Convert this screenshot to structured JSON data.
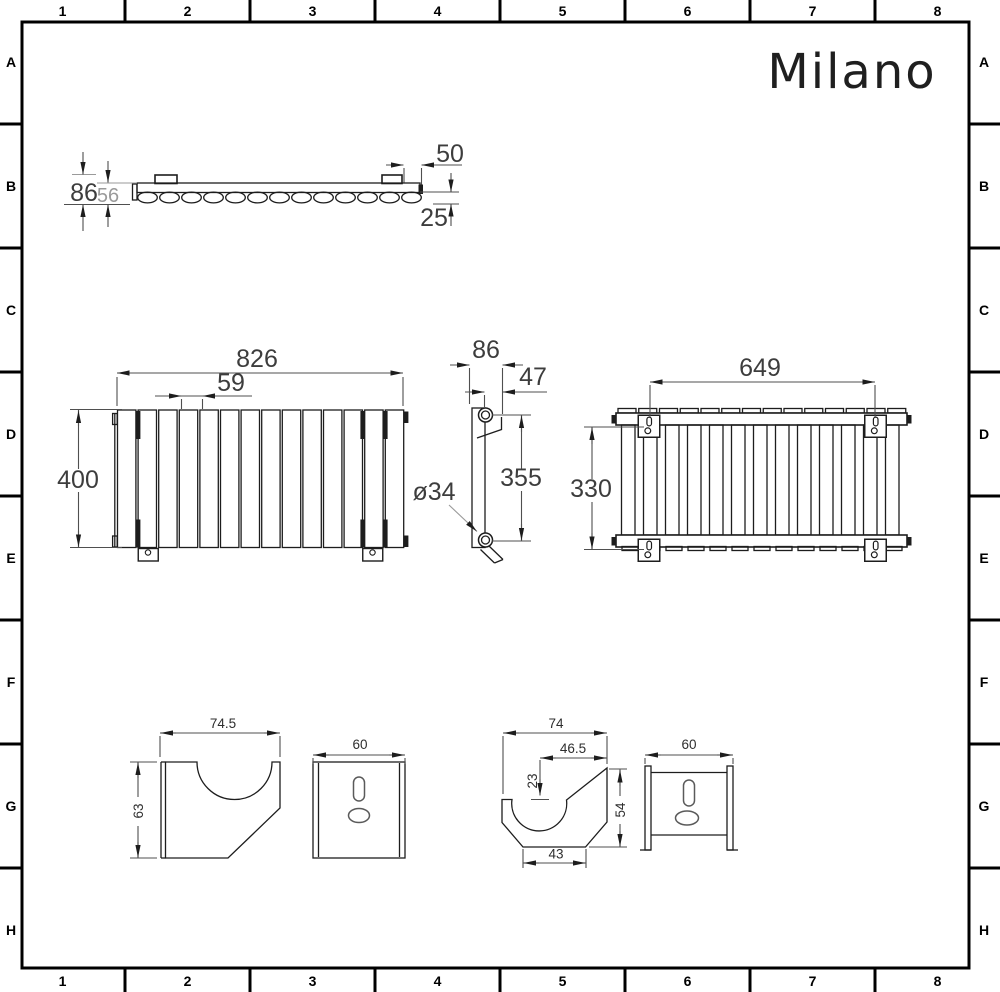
{
  "logo": "Milano",
  "grid": {
    "cols": [
      "1",
      "2",
      "3",
      "4",
      "5",
      "6",
      "7",
      "8"
    ],
    "rows": [
      "A",
      "B",
      "C",
      "D",
      "E",
      "F",
      "G",
      "H"
    ]
  },
  "top_view": {
    "overall_depth": "86",
    "body_depth": "56",
    "end_offset": "50",
    "tube_depth": "25"
  },
  "front_view": {
    "width": "826",
    "panel_pitch": "59",
    "height": "400"
  },
  "side_view": {
    "overall_depth": "86",
    "inner_depth": "47",
    "pipe_centres": "355",
    "tube_diameter": "ø34"
  },
  "rear_view": {
    "bracket_centres_h": "649",
    "bracket_centres_v": "330"
  },
  "bracket_detail_a": {
    "width": "74.5",
    "height": "63",
    "face_width": "60"
  },
  "bracket_detail_b": {
    "width": "74",
    "notch_offset": "46.5",
    "notch_depth": "23",
    "height": "54",
    "base_width": "43",
    "face_width": "60"
  }
}
